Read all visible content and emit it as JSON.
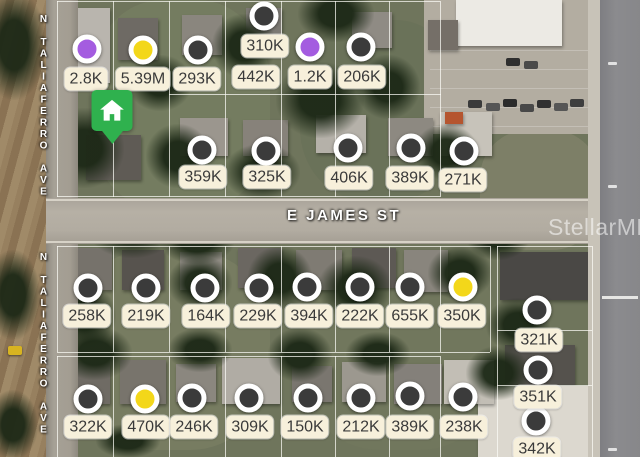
{
  "app": {
    "watermark": "StellarMLS"
  },
  "streets": {
    "taliaferro_top": "N TALIAFERRO AVE",
    "taliaferro_bottom": "N TALIAFERRO AVE",
    "james": "E JAMES ST"
  },
  "colors": {
    "dark": "#3b3b3b",
    "purple": "#a45ce0",
    "yellow": "#f3d71a",
    "selected_green": "#2fb14e",
    "ring": "#ffffff",
    "label_bg": "#f7f0db",
    "label_text": "#3a3a3a"
  },
  "selected_marker": {
    "x": 112,
    "y": 90
  },
  "markers": [
    {
      "label": "2.8K",
      "lx": 86,
      "ly": 79,
      "dot": "purple",
      "cx": 87,
      "cy": 49
    },
    {
      "label": "5.39M",
      "lx": 143,
      "ly": 79,
      "dot": "yellow",
      "cx": 143,
      "cy": 50
    },
    {
      "label": "293K",
      "lx": 197,
      "ly": 79,
      "dot": "dark",
      "cx": 198,
      "cy": 50
    },
    {
      "label": "310K",
      "lx": 265,
      "ly": 46,
      "dot": "dark",
      "cx": 264,
      "cy": 16
    },
    {
      "label": "442K",
      "lx": 256,
      "ly": 77,
      "dot": null
    },
    {
      "label": "1.2K",
      "lx": 310,
      "ly": 77,
      "dot": "purple",
      "cx": 310,
      "cy": 47
    },
    {
      "label": "206K",
      "lx": 362,
      "ly": 77,
      "dot": "dark",
      "cx": 361,
      "cy": 47
    },
    {
      "label": "359K",
      "lx": 203,
      "ly": 177,
      "dot": "dark",
      "cx": 202,
      "cy": 150
    },
    {
      "label": "325K",
      "lx": 267,
      "ly": 177,
      "dot": "dark",
      "cx": 266,
      "cy": 151
    },
    {
      "label": "406K",
      "lx": 349,
      "ly": 178,
      "dot": "dark",
      "cx": 348,
      "cy": 148
    },
    {
      "label": "389K",
      "lx": 410,
      "ly": 178,
      "dot": "dark",
      "cx": 411,
      "cy": 148
    },
    {
      "label": "271K",
      "lx": 463,
      "ly": 180,
      "dot": "dark",
      "cx": 464,
      "cy": 151
    },
    {
      "label": "258K",
      "lx": 87,
      "ly": 316,
      "dot": "dark",
      "cx": 88,
      "cy": 288
    },
    {
      "label": "219K",
      "lx": 146,
      "ly": 316,
      "dot": "dark",
      "cx": 146,
      "cy": 288
    },
    {
      "label": "164K",
      "lx": 206,
      "ly": 316,
      "dot": "dark",
      "cx": 205,
      "cy": 288
    },
    {
      "label": "229K",
      "lx": 258,
      "ly": 316,
      "dot": "dark",
      "cx": 259,
      "cy": 288
    },
    {
      "label": "394K",
      "lx": 309,
      "ly": 316,
      "dot": "dark",
      "cx": 307,
      "cy": 287
    },
    {
      "label": "222K",
      "lx": 360,
      "ly": 316,
      "dot": "dark",
      "cx": 360,
      "cy": 287
    },
    {
      "label": "655K",
      "lx": 410,
      "ly": 316,
      "dot": "dark",
      "cx": 410,
      "cy": 287
    },
    {
      "label": "350K",
      "lx": 462,
      "ly": 316,
      "dot": "yellow",
      "cx": 463,
      "cy": 287
    },
    {
      "label": "321K",
      "lx": 539,
      "ly": 340,
      "dot": "dark",
      "cx": 537,
      "cy": 310
    },
    {
      "label": "351K",
      "lx": 538,
      "ly": 397,
      "dot": "dark",
      "cx": 538,
      "cy": 370
    },
    {
      "label": "342K",
      "lx": 537,
      "ly": 449,
      "dot": "dark",
      "cx": 536,
      "cy": 421
    },
    {
      "label": "322K",
      "lx": 88,
      "ly": 427,
      "dot": "dark",
      "cx": 88,
      "cy": 399
    },
    {
      "label": "470K",
      "lx": 146,
      "ly": 427,
      "dot": "yellow",
      "cx": 145,
      "cy": 399
    },
    {
      "label": "246K",
      "lx": 194,
      "ly": 427,
      "dot": "dark",
      "cx": 192,
      "cy": 398
    },
    {
      "label": "309K",
      "lx": 250,
      "ly": 427,
      "dot": "dark",
      "cx": 249,
      "cy": 398
    },
    {
      "label": "150K",
      "lx": 305,
      "ly": 427,
      "dot": "dark",
      "cx": 308,
      "cy": 398
    },
    {
      "label": "212K",
      "lx": 361,
      "ly": 427,
      "dot": "dark",
      "cx": 361,
      "cy": 398
    },
    {
      "label": "389K-south",
      "display": "389K",
      "lx": 410,
      "ly": 427,
      "dot": "dark",
      "cx": 410,
      "cy": 396
    },
    {
      "label": "238K",
      "lx": 464,
      "ly": 427,
      "dot": "dark",
      "cx": 463,
      "cy": 397
    }
  ]
}
